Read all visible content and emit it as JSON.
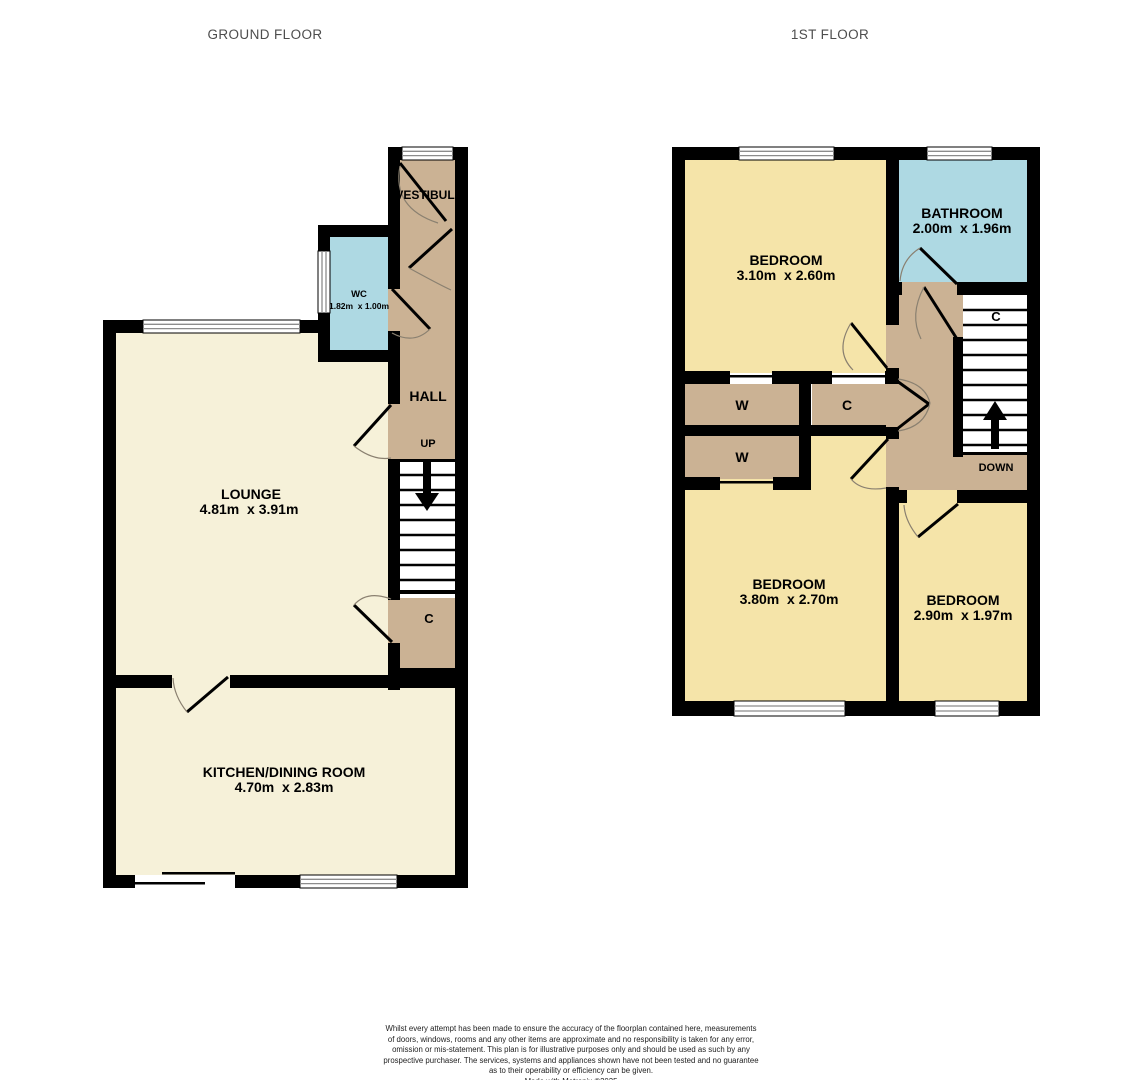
{
  "titles": {
    "ground_floor": "GROUND FLOOR",
    "first_floor": "1ST FLOOR"
  },
  "ground_floor": {
    "vestibule": "VESTIBULE",
    "wc": "WC",
    "wc_dims": "1.82m  x 1.00m",
    "hall": "HALL",
    "up": "UP",
    "lounge": "LOUNGE",
    "lounge_dims": "4.81m  x 3.91m",
    "cupboard": "C",
    "kitchen": "KITCHEN/DINING ROOM",
    "kitchen_dims": "4.70m  x 2.83m"
  },
  "first_floor": {
    "bedroom_front": "BEDROOM",
    "bedroom_front_dims": "3.10m  x 2.60m",
    "bathroom": "BATHROOM",
    "bathroom_dims": "2.00m  x 1.96m",
    "stairs_cupboard": "C",
    "wardrobe_1": "W",
    "wardrobe_2": "W",
    "cupboard": "C",
    "down": "DOWN",
    "bedroom_back": "BEDROOM",
    "bedroom_back_dims": "3.80m  x 2.70m",
    "bedroom_side": "BEDROOM",
    "bedroom_side_dims": "2.90m  x 1.97m"
  },
  "colors": {
    "wall": "#000000",
    "floor_cream": "#F6F1D9",
    "floor_yellow": "#F5E4A9",
    "floor_tan": "#CBB294",
    "floor_blue": "#AED9E3",
    "stairs_white": "#FFFFFF"
  },
  "footer": {
    "disclaimer_lines": [
      "Whilst every attempt has been made to ensure the accuracy of the floorplan contained here, measurements",
      "of doors, windows, rooms and any other items are approximate and no responsibility is taken for any error,",
      "omission or mis-statement. This plan is for illustrative purposes only and should be used as such by any",
      "prospective purchaser. The services, systems and appliances shown have not been tested and no guarantee",
      "as to their operability or efficiency can be given."
    ],
    "credit": "Made with Metropix ©2025"
  }
}
